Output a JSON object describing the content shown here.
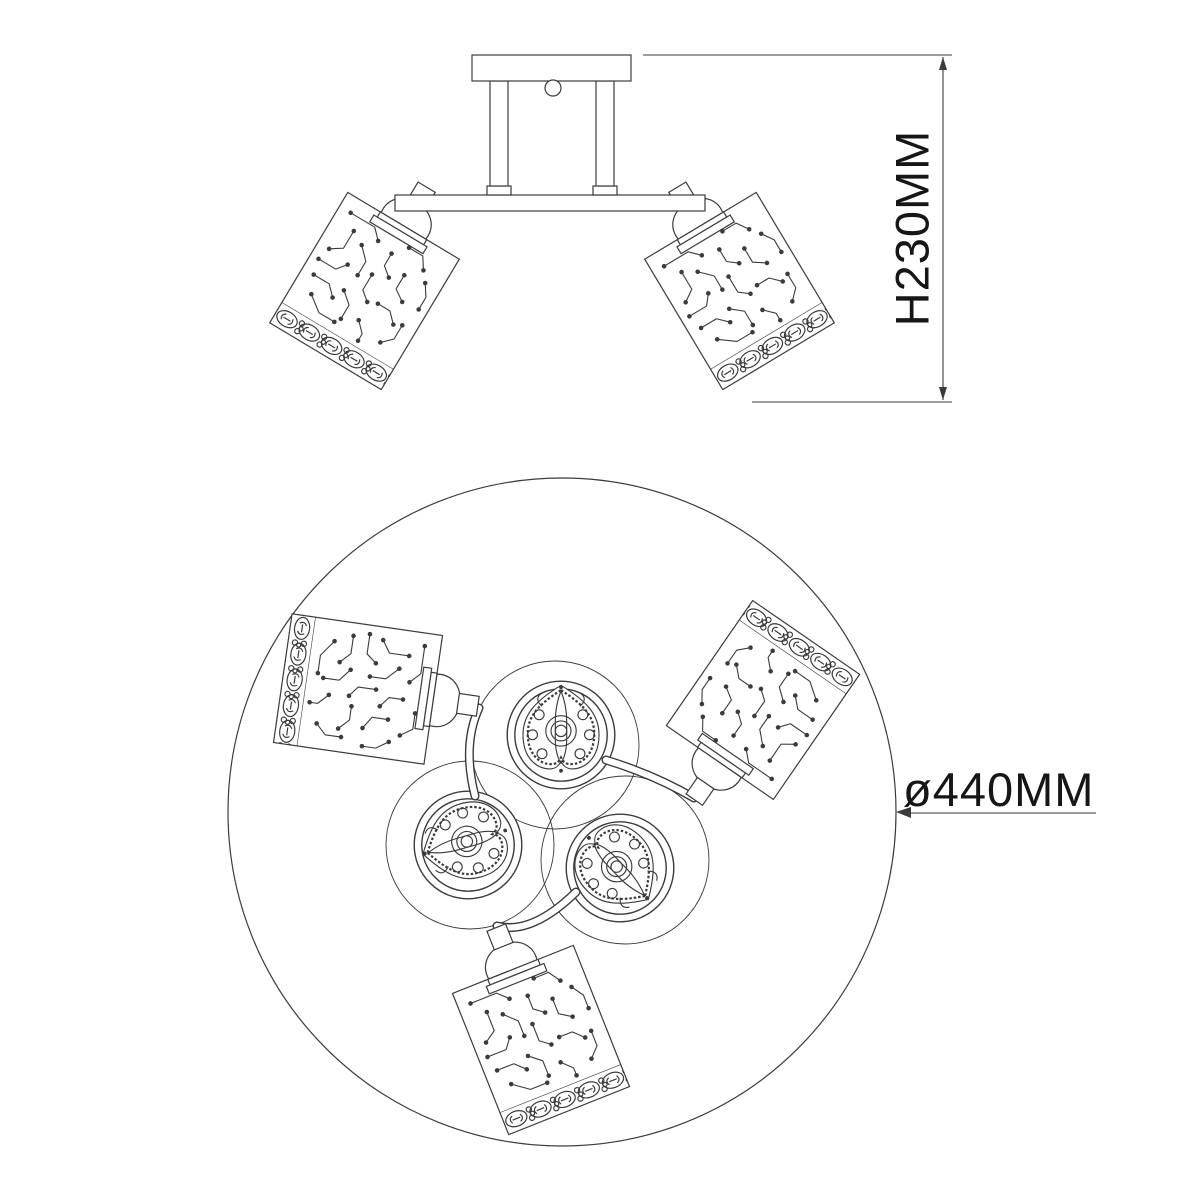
{
  "canvas": {
    "background": "#ffffff",
    "line_color": "#3b3b3b",
    "text_color": "#161616"
  },
  "product_drawing": {
    "subject": "three-light ceiling chandelier technical drawing",
    "lamp_count": 3,
    "dimensions": {
      "height_label": "H230MM",
      "diameter_label": "ø440MM"
    }
  }
}
